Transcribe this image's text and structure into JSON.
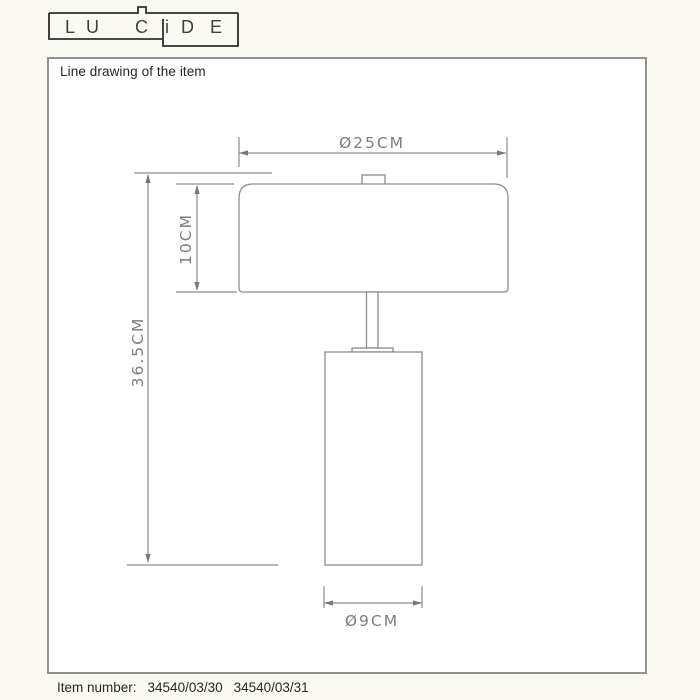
{
  "window": {
    "background_color": "#fbfaf2",
    "panel_border_color": "#919191",
    "drawing_line_color": "#8c8c8c",
    "dimension_text_color": "#7d7d7d"
  },
  "logo": {
    "brand": "LUCIDE",
    "letters": [
      "L",
      "U",
      "C",
      "i",
      "D",
      "E"
    ]
  },
  "panel": {
    "title": "Line drawing of the item"
  },
  "drawing": {
    "dimensions": {
      "shade_diameter": "Ø25CM",
      "shade_height": "10CM",
      "total_height": "36.5CM",
      "base_diameter": "Ø9CM"
    }
  },
  "footer": {
    "label": "Item number:",
    "item_numbers": [
      "34540/03/30",
      "34540/03/31"
    ]
  }
}
